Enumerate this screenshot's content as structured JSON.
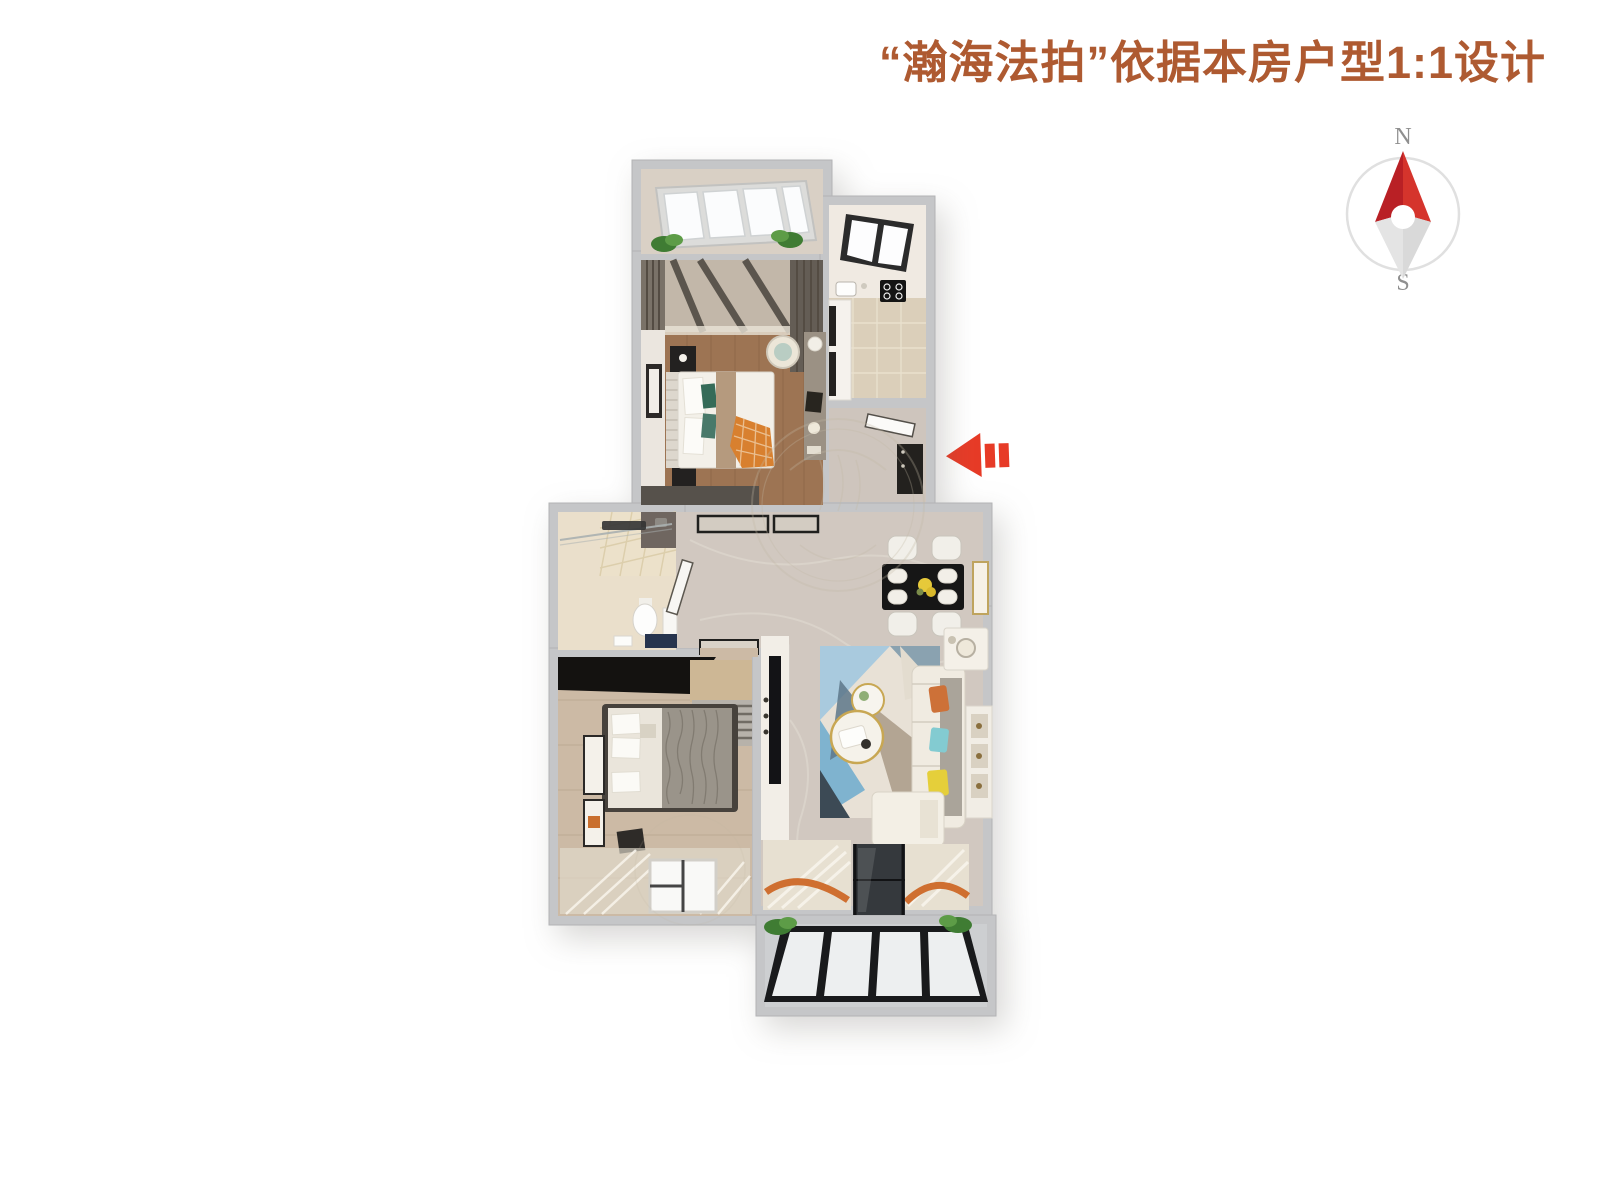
{
  "header": {
    "title": "“瀚海法拍”依据本房户型1:1设计",
    "title_color": "#ae5a31"
  },
  "compass": {
    "icon": "compass-icon",
    "north_label": "N",
    "south_label": "S",
    "needle_red": "#d5342c",
    "needle_red_dark": "#b92025",
    "needle_gray": "#d9d9d9",
    "ring_gray": "#e0e0e0"
  },
  "entrance_arrow": {
    "icon": "arrow-left-icon",
    "color": "#e73b27"
  },
  "colors": {
    "accent_red": "#e73b27",
    "wall_gray": "#c5c6c8",
    "marble_floor": "#d1c8c0",
    "master_wood_floor": "#9d7453",
    "second_wood_floor": "#ccbaa5",
    "kitchen_tile": "#dbcfba",
    "bathroom_tile": "#eadfcb",
    "balcony_floor": "#cdcfd1",
    "sofa_cream": "#f0ebe1",
    "rug_blue": "#a9cade",
    "pillow_orange": "#cd7138",
    "pillow_teal": "#83cbd1",
    "pillow_yellow": "#e5cf3a"
  }
}
